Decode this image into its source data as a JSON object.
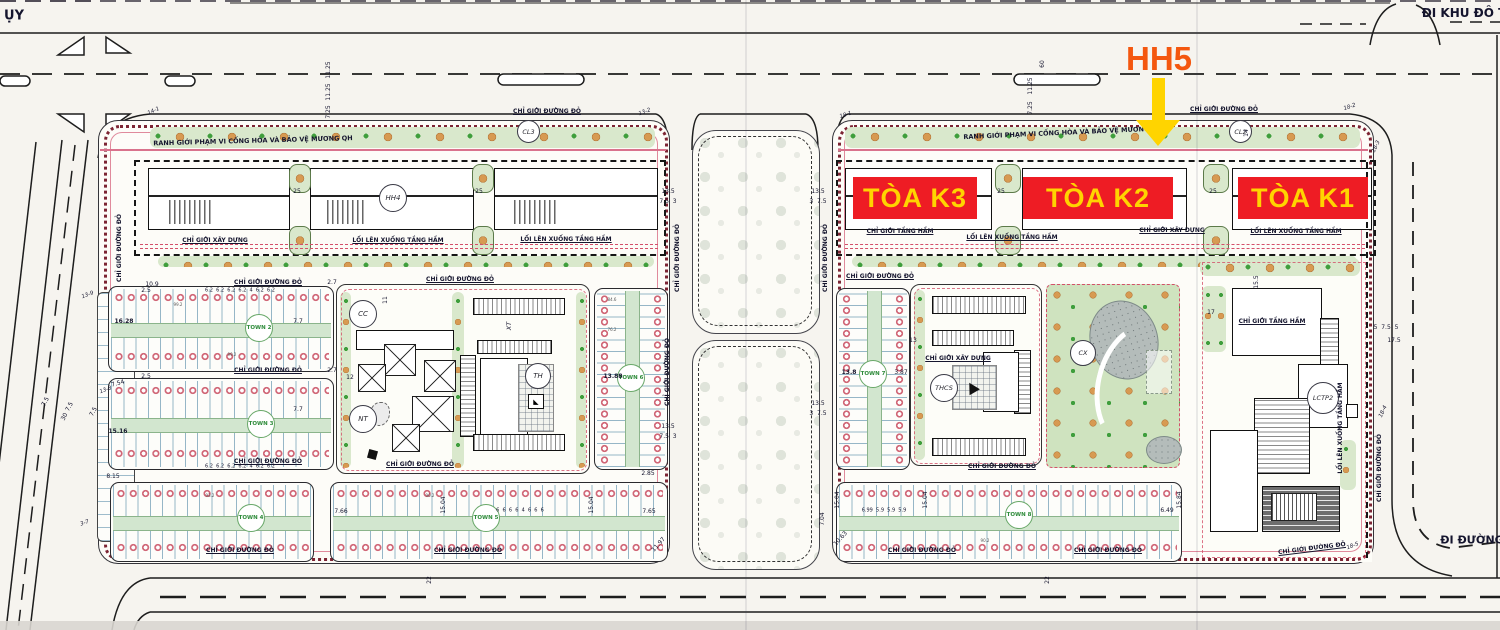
{
  "title": "Master plan with HH5 / Toa K1-K2-K3 highlight overlay",
  "overlay": {
    "hh5_label": "HH5",
    "hh5_color": "#f4570f",
    "arrow_color": "#ffd400",
    "box_color": "#ee1c24",
    "box_text_color": "#ffd400",
    "towers": [
      {
        "label": "TÒA K3"
      },
      {
        "label": "TÒA K2"
      },
      {
        "label": "TÒA K1"
      }
    ]
  },
  "buildings": {
    "hh4": "HH4",
    "cl3": "CL3",
    "cl2": "CL2",
    "cc": "CC",
    "nt": "NT",
    "th": "TH",
    "xt": "XT",
    "thcs": "THCS",
    "cx": "CX",
    "lctp2": "LCTP2"
  },
  "town_blocks": [
    "TOWN 2",
    "TOWN 3",
    "TOWN 4",
    "TOWN 5",
    "TOWN 6",
    "TOWN 7",
    "TOWN 8"
  ],
  "recurring_lot_areas": [
    "99.2",
    "93.2",
    "90.2",
    "88.8",
    "84.6",
    "76.2",
    "102.6",
    "108.6",
    "110.8",
    "118.9",
    "125",
    "133.9",
    "137.8",
    "143.9",
    "100.5",
    "102.9",
    "77.0",
    "66.2"
  ],
  "recurring_lot_widths": [
    "6.2",
    "6",
    "5.9",
    "5.5",
    "7",
    "7.7",
    "7.65",
    "7.66",
    "6.99",
    "6.49",
    "6.04",
    "8.04",
    "8.15",
    "7.54",
    "2.5",
    "2.7",
    "2.85",
    "2"
  ],
  "colors": {
    "paper": "#f6f4ef",
    "green_buffer": "#d9e8cc",
    "tree_orange": "#d79a52",
    "shrub_green": "#3f9e3c",
    "boundary_red": "#d4506a",
    "bead_maroon": "#7c2433",
    "lot_line_blue": "#5087a5",
    "town_green": "#2e8b3a",
    "road_line": "#1d1d1d"
  },
  "annotations": [
    {
      "t": "ỤY",
      "x": 14,
      "y": 16,
      "s": 13,
      "w": 700,
      "n": "road-label-top-left"
    },
    {
      "t": "ĐI KHU ĐÔ T",
      "x": 1464,
      "y": 13,
      "s": 12,
      "w": 700,
      "n": "road-label-top-right"
    },
    {
      "t": "ĐI ĐƯỜNG",
      "x": 1472,
      "y": 540,
      "s": 11,
      "w": 700,
      "n": "road-label-bottom-right"
    },
    {
      "t": "RANH GIỚI PHẠM VI CỐNG HÒA VÀ BẢO VỆ MƯƠNG QH",
      "x": 253,
      "y": 141,
      "r": -1.5,
      "s": 6.5,
      "w": 700,
      "n": "boundary-label"
    },
    {
      "t": "RANH GIỚI PHẠM VI CỐNG HÒA VÀ BẢO VỆ MƯƠNG QH",
      "x": 1063,
      "y": 133,
      "r": -2.5,
      "s": 6.5,
      "w": 700,
      "n": "boundary-label"
    },
    {
      "t": "CHỈ GIỚI ĐƯỜNG ĐỎ",
      "x": 547,
      "y": 112,
      "w": 700,
      "u": 1,
      "n": "boundary-label"
    },
    {
      "t": "CHỈ GIỚI ĐƯỜNG ĐỎ",
      "x": 1224,
      "y": 110,
      "w": 700,
      "u": 1,
      "n": "boundary-label"
    },
    {
      "t": "CHỈ GIỚI ĐƯỜNG ĐỎ",
      "x": 268,
      "y": 283,
      "w": 700,
      "u": 1,
      "n": "boundary-label"
    },
    {
      "t": "CHỈ GIỚI ĐƯỜNG ĐỎ",
      "x": 268,
      "y": 371,
      "w": 700,
      "u": 1,
      "n": "boundary-label"
    },
    {
      "t": "CHỈ GIỚI ĐƯỜNG ĐỎ",
      "x": 268,
      "y": 462,
      "w": 700,
      "u": 1,
      "n": "boundary-label"
    },
    {
      "t": "CHỈ GIỚI ĐƯỜNG ĐỎ",
      "x": 240,
      "y": 551,
      "w": 700,
      "u": 1,
      "n": "boundary-label"
    },
    {
      "t": "CHỈ GIỚI ĐƯỜNG ĐỎ",
      "x": 468,
      "y": 551,
      "w": 700,
      "u": 1,
      "n": "boundary-label"
    },
    {
      "t": "CHỈ GIỚI ĐƯỜNG ĐỎ",
      "x": 460,
      "y": 280,
      "w": 700,
      "u": 1,
      "n": "boundary-label"
    },
    {
      "t": "CHỈ GIỚI ĐƯỜNG ĐỎ",
      "x": 420,
      "y": 465,
      "w": 700,
      "u": 1,
      "n": "boundary-label"
    },
    {
      "t": "CHỈ GIỚI ĐƯỜNG ĐỎ",
      "x": 880,
      "y": 277,
      "w": 700,
      "u": 1,
      "n": "boundary-label"
    },
    {
      "t": "CHỈ GIỚI ĐƯỜNG ĐỎ",
      "x": 1002,
      "y": 467,
      "w": 700,
      "u": 1,
      "n": "boundary-label"
    },
    {
      "t": "CHỈ GIỚI ĐƯỜNG ĐỎ",
      "x": 922,
      "y": 551,
      "w": 700,
      "u": 1,
      "n": "boundary-label"
    },
    {
      "t": "CHỈ GIỚI ĐƯỜNG ĐỎ",
      "x": 1108,
      "y": 551,
      "w": 700,
      "u": 1,
      "n": "boundary-label"
    },
    {
      "t": "CHỈ GIỚI ĐƯỜNG ĐỎ",
      "x": 1312,
      "y": 549,
      "r": -7,
      "w": 700,
      "u": 1,
      "n": "boundary-label"
    },
    {
      "t": "CHỈ GIỚI ĐƯỜNG ĐỎ",
      "x": 120,
      "y": 248,
      "r": -90,
      "w": 700,
      "n": "boundary-label"
    },
    {
      "t": "CHỈ GIỚI ĐƯỜNG ĐỎ",
      "x": 678,
      "y": 258,
      "r": -90,
      "w": 700,
      "n": "boundary-label"
    },
    {
      "t": "CHỈ GIỚI ĐƯỜNG ĐỎ",
      "x": 826,
      "y": 258,
      "r": -90,
      "w": 700,
      "n": "boundary-label"
    },
    {
      "t": "CHỈ GIỚI ĐƯỜNG ĐỎ",
      "x": 668,
      "y": 372,
      "r": -90,
      "w": 700,
      "n": "boundary-label"
    },
    {
      "t": "CHỈ GIỚI ĐƯỜNG ĐỎ",
      "x": 1380,
      "y": 468,
      "r": -90,
      "w": 700,
      "n": "boundary-label"
    },
    {
      "t": "CHỈ GIỚI XÂY DỰNG",
      "x": 215,
      "y": 241,
      "w": 700,
      "u": 1,
      "n": "boundary-label"
    },
    {
      "t": "CHỈ GIỚI XÂY DỰNG",
      "x": 1172,
      "y": 231,
      "w": 700,
      "u": 1,
      "n": "boundary-label"
    },
    {
      "t": "CHỈ GIỚI XÂY DỰNG",
      "x": 958,
      "y": 359,
      "w": 700,
      "u": 1,
      "n": "boundary-label"
    },
    {
      "t": "CHỈ GIỚI TẦNG HẦM",
      "x": 900,
      "y": 232,
      "w": 700,
      "u": 1,
      "n": "boundary-label"
    },
    {
      "t": "CHỈ GIỚI TẦNG HẦM",
      "x": 1272,
      "y": 322,
      "w": 700,
      "u": 1,
      "n": "boundary-label"
    },
    {
      "t": "LỐI LÊN XUỐNG TẦNG HẦM",
      "x": 398,
      "y": 241,
      "w": 700,
      "u": 1,
      "n": "boundary-label"
    },
    {
      "t": "LỐI LÊN XUỐNG TẦNG HẦM",
      "x": 566,
      "y": 240,
      "w": 700,
      "u": 1,
      "n": "boundary-label"
    },
    {
      "t": "LỐI LÊN XUỐNG TẦNG HẦM",
      "x": 1012,
      "y": 238,
      "w": 700,
      "u": 1,
      "n": "boundary-label"
    },
    {
      "t": "LỐI LÊN XUỐNG TẦNG HẦM",
      "x": 1296,
      "y": 232,
      "w": 700,
      "u": 1,
      "n": "boundary-label"
    },
    {
      "t": "LỐI LÊN XUỐNG TẦNG HẦM",
      "x": 1341,
      "y": 428,
      "r": -90,
      "w": 700,
      "n": "boundary-label"
    },
    {
      "t": "XT",
      "x": 509,
      "y": 326,
      "r": -90,
      "s": 6.5,
      "i": 1,
      "n": "building-code"
    },
    {
      "t": "25",
      "x": 297,
      "y": 192,
      "n": "dimension-label"
    },
    {
      "t": "25",
      "x": 479,
      "y": 192,
      "n": "dimension-label"
    },
    {
      "t": "25",
      "x": 1001,
      "y": 192,
      "n": "dimension-label"
    },
    {
      "t": "25",
      "x": 1213,
      "y": 192,
      "n": "dimension-label"
    },
    {
      "t": "11.25",
      "x": 329,
      "y": 70,
      "r": -90,
      "n": "dimension-label"
    },
    {
      "t": "11.25",
      "x": 329,
      "y": 92,
      "r": -90,
      "n": "dimension-label"
    },
    {
      "t": "11.25",
      "x": 1031,
      "y": 86,
      "r": -90,
      "n": "dimension-label"
    },
    {
      "t": "7.25",
      "x": 329,
      "y": 112,
      "r": -90,
      "n": "dimension-label"
    },
    {
      "t": "7.25",
      "x": 1031,
      "y": 108,
      "r": -90,
      "n": "dimension-label"
    },
    {
      "t": "60",
      "x": 1043,
      "y": 64,
      "r": -90,
      "n": "dimension-label"
    },
    {
      "t": "13.5",
      "x": 668,
      "y": 192,
      "n": "dimension-label"
    },
    {
      "t": "13.5",
      "x": 818,
      "y": 192,
      "n": "dimension-label"
    },
    {
      "t": "13.5",
      "x": 668,
      "y": 427,
      "n": "dimension-label"
    },
    {
      "t": "13.5",
      "x": 818,
      "y": 404,
      "n": "dimension-label"
    },
    {
      "t": "7.5  3",
      "x": 668,
      "y": 202,
      "n": "dimension-label"
    },
    {
      "t": "7.5  3",
      "x": 668,
      "y": 437,
      "n": "dimension-label"
    },
    {
      "t": "3  7.5",
      "x": 818,
      "y": 202,
      "n": "dimension-label"
    },
    {
      "t": "3  7.5",
      "x": 818,
      "y": 414,
      "n": "dimension-label"
    },
    {
      "t": "22",
      "x": 430,
      "y": 580,
      "r": -90,
      "n": "dimension-label"
    },
    {
      "t": "22",
      "x": 1048,
      "y": 580,
      "r": -90,
      "n": "dimension-label"
    },
    {
      "t": "30",
      "x": 65,
      "y": 417,
      "r": -62,
      "n": "dimension-label"
    },
    {
      "t": "7.5",
      "x": 46,
      "y": 402,
      "r": -62,
      "n": "dimension-label"
    },
    {
      "t": "7.5",
      "x": 70,
      "y": 407,
      "r": -62,
      "n": "dimension-label"
    },
    {
      "t": "7.5",
      "x": 94,
      "y": 412,
      "r": -62,
      "n": "dimension-label"
    },
    {
      "t": "16.28",
      "x": 124,
      "y": 322,
      "w": 700,
      "n": "dimension-label"
    },
    {
      "t": "15.16",
      "x": 118,
      "y": 432,
      "w": 700,
      "n": "dimension-label"
    },
    {
      "t": "13.88",
      "x": 613,
      "y": 377,
      "w": 700,
      "n": "dimension-label"
    },
    {
      "t": "13.8",
      "x": 849,
      "y": 373,
      "w": 700,
      "n": "dimension-label"
    },
    {
      "t": "3.87",
      "x": 901,
      "y": 373,
      "n": "dimension-label"
    },
    {
      "t": "7.7",
      "x": 298,
      "y": 322,
      "n": "dimension-label"
    },
    {
      "t": "7.7",
      "x": 298,
      "y": 410,
      "n": "dimension-label"
    },
    {
      "t": "10.9",
      "x": 152,
      "y": 285,
      "n": "dimension-label"
    },
    {
      "t": "2.5",
      "x": 146,
      "y": 291,
      "n": "dimension-label"
    },
    {
      "t": "2.5",
      "x": 146,
      "y": 377,
      "n": "dimension-label"
    },
    {
      "t": "2.7",
      "x": 332,
      "y": 283,
      "n": "dimension-label"
    },
    {
      "t": "2.7",
      "x": 332,
      "y": 371,
      "n": "dimension-label"
    },
    {
      "t": "7.54",
      "x": 118,
      "y": 384,
      "r": -15,
      "n": "dimension-label"
    },
    {
      "t": "8.15",
      "x": 113,
      "y": 477,
      "n": "dimension-label"
    },
    {
      "t": "2.85",
      "x": 648,
      "y": 474,
      "n": "dimension-label"
    },
    {
      "t": "7.65",
      "x": 649,
      "y": 512,
      "n": "dimension-label"
    },
    {
      "t": "7.66",
      "x": 341,
      "y": 512,
      "n": "dimension-label"
    },
    {
      "t": "6.99  5.9  5.9  5.9",
      "x": 884,
      "y": 511,
      "s": 5,
      "n": "dimension-label"
    },
    {
      "t": "6.49",
      "x": 1167,
      "y": 511,
      "n": "dimension-label"
    },
    {
      "t": "15.04",
      "x": 444,
      "y": 505,
      "r": -90,
      "n": "dimension-label"
    },
    {
      "t": "15.04",
      "x": 592,
      "y": 505,
      "r": -90,
      "n": "dimension-label"
    },
    {
      "t": "15.04",
      "x": 838,
      "y": 500,
      "r": -90,
      "n": "dimension-label"
    },
    {
      "t": "15.04",
      "x": 926,
      "y": 500,
      "r": -90,
      "n": "dimension-label"
    },
    {
      "t": "15.84",
      "x": 1180,
      "y": 500,
      "r": -90,
      "n": "dimension-label"
    },
    {
      "t": "7.04",
      "x": 823,
      "y": 519,
      "r": -90,
      "n": "dimension-label"
    },
    {
      "t": "11.97",
      "x": 659,
      "y": 545,
      "r": -48,
      "n": "dimension-label"
    },
    {
      "t": "10.63",
      "x": 841,
      "y": 539,
      "r": -48,
      "n": "dimension-label"
    },
    {
      "t": "17.5",
      "x": 1394,
      "y": 341,
      "n": "dimension-label"
    },
    {
      "t": "5  7.5  5",
      "x": 1386,
      "y": 328,
      "n": "dimension-label"
    },
    {
      "t": "15.5",
      "x": 1257,
      "y": 282,
      "r": -90,
      "n": "dimension-label"
    },
    {
      "t": "17",
      "x": 1211,
      "y": 313,
      "n": "dimension-label"
    },
    {
      "t": "13",
      "x": 913,
      "y": 341,
      "n": "dimension-label"
    },
    {
      "t": "12",
      "x": 350,
      "y": 378,
      "n": "dimension-label"
    },
    {
      "t": "11",
      "x": 386,
      "y": 300,
      "r": -90,
      "n": "dimension-label"
    },
    {
      "t": "14",
      "x": 1247,
      "y": 133,
      "r": -90,
      "n": "dimension-label"
    },
    {
      "t": "6.2  6.2  6.2  6.2  4  6.2  6.2",
      "x": 240,
      "y": 291,
      "s": 5,
      "n": "dimension-label"
    },
    {
      "t": "6.2  6.2  6.2  6.2  4  6.2  6.2",
      "x": 240,
      "y": 467,
      "s": 5,
      "n": "dimension-label"
    },
    {
      "t": "6  6  6  6  4  6  6  6",
      "x": 520,
      "y": 511,
      "s": 5,
      "n": "dimension-label"
    },
    {
      "t": "99.2",
      "x": 178,
      "y": 305,
      "s": 4,
      "c": "#555",
      "n": "lot-area-label"
    },
    {
      "t": "99.2",
      "x": 232,
      "y": 355,
      "s": 4,
      "c": "#555",
      "n": "lot-area-label"
    },
    {
      "t": "93.2",
      "x": 210,
      "y": 496,
      "s": 4,
      "c": "#555",
      "n": "lot-area-label"
    },
    {
      "t": "90.2",
      "x": 430,
      "y": 496,
      "s": 4,
      "c": "#555",
      "n": "lot-area-label"
    },
    {
      "t": "90.2",
      "x": 985,
      "y": 541,
      "s": 4,
      "c": "#555",
      "n": "lot-area-label"
    },
    {
      "t": "76.2",
      "x": 612,
      "y": 330,
      "s": 4,
      "c": "#555",
      "n": "lot-area-label"
    },
    {
      "t": "84.6",
      "x": 612,
      "y": 300,
      "s": 4,
      "c": "#555",
      "n": "lot-area-label"
    },
    {
      "t": "14-1",
      "x": 154,
      "y": 112,
      "r": -25,
      "s": 5.5,
      "i": 1,
      "n": "boundary-point-label"
    },
    {
      "t": "13-2",
      "x": 645,
      "y": 113,
      "r": -20,
      "s": 5.5,
      "i": 1,
      "n": "boundary-point-label"
    },
    {
      "t": "18-1",
      "x": 846,
      "y": 116,
      "r": -18,
      "s": 5.5,
      "i": 1,
      "n": "boundary-point-label"
    },
    {
      "t": "18-2",
      "x": 1350,
      "y": 108,
      "r": -18,
      "s": 5.5,
      "i": 1,
      "n": "boundary-point-label"
    },
    {
      "t": "18-3",
      "x": 1377,
      "y": 147,
      "r": -65,
      "s": 5.5,
      "i": 1,
      "n": "boundary-point-label"
    },
    {
      "t": "13-9",
      "x": 88,
      "y": 296,
      "r": -20,
      "s": 5.5,
      "i": 1,
      "n": "boundary-point-label"
    },
    {
      "t": "13-8",
      "x": 106,
      "y": 391,
      "r": -20,
      "s": 5.5,
      "i": 1,
      "n": "boundary-point-label"
    },
    {
      "t": "3-7",
      "x": 85,
      "y": 524,
      "r": -20,
      "s": 5.5,
      "i": 1,
      "n": "boundary-point-label"
    },
    {
      "t": "18-4",
      "x": 1384,
      "y": 412,
      "r": -65,
      "s": 5.5,
      "i": 1,
      "n": "boundary-point-label"
    },
    {
      "t": "18-5",
      "x": 1353,
      "y": 547,
      "r": -20,
      "s": 5.5,
      "i": 1,
      "n": "boundary-point-label"
    }
  ]
}
